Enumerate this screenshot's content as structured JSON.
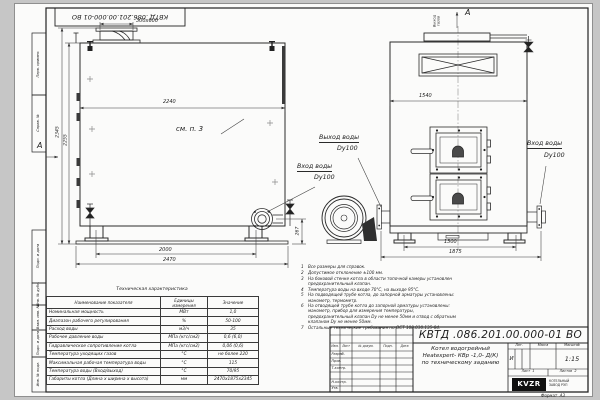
{
  "frame": {
    "stamp_number": "КВТД .086.201.00.000-01 ВО",
    "margin_labels": [
      "Перв. примен.",
      "Справ. №",
      "Подп. и дата",
      "Инв. № дубл.",
      "Взам. инв. №",
      "Подп. и дата",
      "Инв. № подл."
    ],
    "format_label": "Формат",
    "format_value": "А3"
  },
  "side_view": {
    "section_label": "А",
    "chimney_dim": "300x600",
    "width_dim": "2240",
    "height_outer": "2345",
    "height_inner": "2255",
    "see_note": "см. п. 3",
    "inlet_line1": "Вход воды",
    "inlet_line2": "Dy100",
    "flange_height": "267",
    "feet_dim": "2000",
    "length_dim": "2470"
  },
  "front_view": {
    "view_label": "А",
    "gas_outlet": "Выход\nгазов",
    "width_dim": "1540",
    "outlet_line1": "Выход воды",
    "outlet_line2": "Dy100",
    "inlet_line1": "Вход воды",
    "inlet_line2": "Dy100",
    "feet_dim": "1300",
    "full_width": "1875"
  },
  "tech_table": {
    "title": "Техническая характеристика",
    "col_name": "Наименование показателя",
    "col_units": "Единицы\nизмерения",
    "col_value": "Значение",
    "rows": [
      [
        "Номинальная мощность",
        "МВт",
        "1,0"
      ],
      [
        "Диапазон рабочего регулирования",
        "%",
        "50-100"
      ],
      [
        "Расход воды",
        "м3/ч",
        "35"
      ],
      [
        "Рабочее давление воды",
        "МПа (кгс/см2)",
        "0,6 (6,0)"
      ],
      [
        "Гидравлическое сопротивление котла",
        "МПа (кгс/см2)",
        "0,06 (0,6)"
      ],
      [
        "Температура уходящих газов",
        "°С",
        "не более 220"
      ],
      [
        "Максимальная рабочая температура воды",
        "°С",
        "115"
      ],
      [
        "Температура воды (Вход/выход)",
        "°С",
        "70/95"
      ],
      [
        "Габариты котла (Длина х ширина х высота)",
        "мм",
        "2470х1875х2345"
      ]
    ]
  },
  "notes": [
    {
      "n": "1",
      "text": "Все размеры для справок."
    },
    {
      "n": "2",
      "text": "Допустимое отклонение ±100 мм."
    },
    {
      "n": "3",
      "text": "На боковой стенке котла в области топочной камеры установлен предохранительный клапан."
    },
    {
      "n": "4",
      "text": "Температура воды на входе 70°С, на выходе 95°С."
    },
    {
      "n": "5",
      "text": "На подводящей трубе котла, до запорной арматуры установлены: манометр, термометр."
    },
    {
      "n": "6",
      "text": "На отводящей трубе котла до запорной арматуры установлены: манометр, прибор для измерения температуры, предохранительный клапан Dy не менее 50мм и отвод с обратным клапаном Dy не менее 50мм."
    },
    {
      "n": "7",
      "text": "Остальные технические требования по ОСТ 108.030.135-84."
    }
  ],
  "title_block": {
    "number": "КВТД .086.201.00.000-01 ВО",
    "title_1": "Котел водогрейный",
    "title_2": "Heatexpert- КВр -1,0- Д(К)",
    "title_3": "по техническому заданию",
    "cols": [
      "Изм.",
      "Лист",
      "№ докум.",
      "Подп.",
      "Дата"
    ],
    "rows": [
      "Разраб.",
      "Пров.",
      "Т.контр.",
      "Н.контр.",
      "Утв."
    ],
    "lit_header": "Лит.",
    "mass_header": "Масса",
    "scale_header": "Масштаб",
    "lit_value": "И",
    "scale_value": "1:15",
    "sheet_label": "Лист",
    "sheet_value": "1",
    "sheets_label": "Листов",
    "sheets_value": "2",
    "logo": "KVZR",
    "logo_caption": "КОТЕЛЬНЫЙ\nЗАВОД РЭП"
  }
}
